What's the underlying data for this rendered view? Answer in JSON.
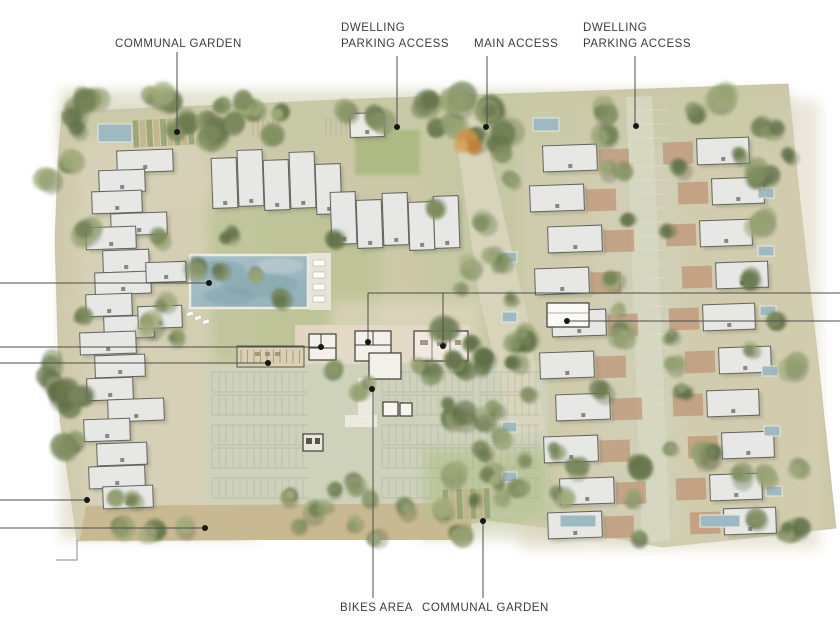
{
  "labels": {
    "communal_garden_top": "COMMUNAL GARDEN",
    "dwelling_parking_left_line1": "DWELLING",
    "dwelling_parking_left_line2": "PARKING ACCESS",
    "main_access": "MAIN ACCESS",
    "dwelling_parking_right_line1": "DWELLING",
    "dwelling_parking_right_line2": "PARKING ACCESS",
    "bikes_area": "BIKES AREA",
    "communal_garden_bottom": "COMMUNAL GARDEN"
  },
  "colors": {
    "ground": "#ccc9a8",
    "paving": "#d8d1b8",
    "plaza": "#e4d9c5",
    "asphalt": "#ced2bb",
    "lawn": "#b6c28f",
    "brick": "#bd9173",
    "roof": "#e7e8e5",
    "floorplan": "#f3f1ea",
    "pool": "#9db9c1",
    "pool_dark": "#7e9fa8",
    "tree_palette": [
      "#7f8f60",
      "#93a070",
      "#6b7b4f",
      "#a3ad7d",
      "#5d6d45"
    ],
    "accent_tree": "#cf9148",
    "leader_line": "#4d4d4d",
    "leader_dot": "#161616",
    "stall_line": "#b0b09e",
    "pergola": "#dbcfb3",
    "hedge": "#c9b992",
    "bed_a": "#c3b488",
    "bed_b": "#96a273"
  }
}
